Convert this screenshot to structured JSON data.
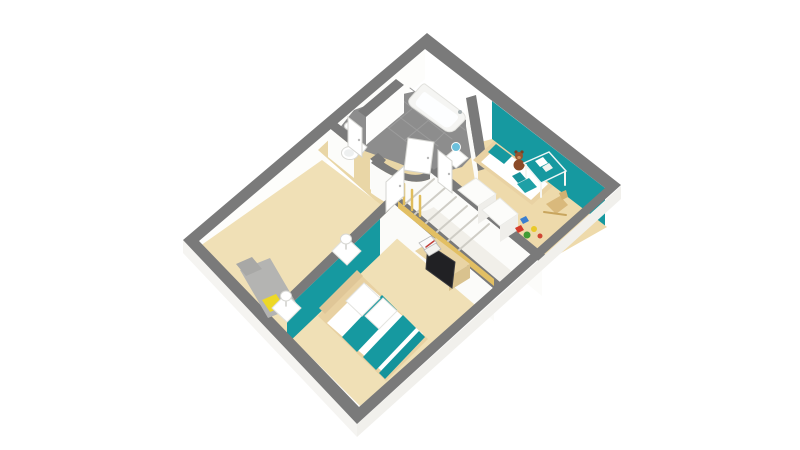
{
  "canvas": {
    "width": 800,
    "height": 450,
    "background": "#ffffff"
  },
  "palette": {
    "wall_top_gray": "#7a7a7a",
    "wall_face_white": "#fcfcfa",
    "accent_teal": "#1699a0",
    "floor_beige": "#f0e0b6",
    "floor_beige_child": "#eedaab",
    "floor_beige_hall": "#e9d6a6",
    "tile_gray": "#8d8d8d",
    "wood_light": "#e8d1a2",
    "stair_wood_yellow": "#e2bf63",
    "cushion_yellow": "#edd826",
    "bench_gray": "#b4b4b2",
    "tv_black": "#212124",
    "teddy_brown": "#8a4a28",
    "toy_red": "#d43a2a",
    "toy_green": "#3f9b35",
    "toy_yellow": "#e9c929",
    "toy_blue": "#3a7fd0"
  },
  "rooms": [
    "master-suite",
    "hall",
    "wc",
    "bathroom",
    "child-bedroom",
    "staircase"
  ],
  "shapes": [
    {
      "name": "nw-wall-inner-face",
      "type": "poly",
      "pts": "425,49 199,241 199,271 425,79",
      "fill": "#fdfdfb"
    },
    {
      "name": "ne-wall-inner-face-white",
      "type": "poly",
      "pts": "425,49 492,101 492,141 425,89",
      "fill": "#ffffff"
    },
    {
      "name": "ne-wall-inner-face-teal",
      "type": "poly",
      "pts": "492,101 605,188 605,228 492,141",
      "fill": "#1699a0"
    },
    {
      "name": "hall-floor",
      "type": "poly",
      "pts": "318,150 380,205 448,215 455,185 420,150 350,120",
      "fill": "#e9d6a6"
    },
    {
      "name": "master-suite-floor",
      "type": "poly",
      "pts": "322,160 200,246 360,406 494,292 424,228 380,204",
      "fill": "#f0e0b6"
    },
    {
      "name": "child-bedroom-floor",
      "type": "poly",
      "pts": "492,139 607,227 547,261 437,173 470,145",
      "fill": "#eedaab"
    },
    {
      "name": "staircase-strip",
      "type": "poly",
      "pts": "430,180 540,268 494,286 398,208",
      "fill": "#f1efe9"
    },
    {
      "name": "bathroom-floor-tiles",
      "type": "poly",
      "pts": "425,89 470,123 482,146 462,167 430,176 398,163 362,150 338,130 354,110 390,97",
      "fill": "#8d8d8d"
    },
    {
      "name": "tile-grout-line",
      "type": "line",
      "x1": 374,
      "y1": 117,
      "x2": 420,
      "y2": 152,
      "stroke": "#9c9c9c",
      "sw": 1
    },
    {
      "name": "tile-grout-line",
      "type": "line",
      "x1": 385,
      "y1": 106,
      "x2": 438,
      "y2": 146,
      "stroke": "#9c9c9c",
      "sw": 1
    },
    {
      "name": "tile-grout-line",
      "type": "line",
      "x1": 397,
      "y1": 96,
      "x2": 452,
      "y2": 139,
      "stroke": "#9c9c9c",
      "sw": 1
    },
    {
      "name": "tile-grout-line",
      "type": "line",
      "x1": 410,
      "y1": 88,
      "x2": 465,
      "y2": 130,
      "stroke": "#9c9c9c",
      "sw": 1
    },
    {
      "name": "tile-grout-line",
      "type": "line",
      "x1": 432,
      "y1": 92,
      "x2": 389,
      "y2": 128,
      "stroke": "#9c9c9c",
      "sw": 1
    },
    {
      "name": "tile-grout-line",
      "type": "line",
      "x1": 448,
      "y1": 104,
      "x2": 405,
      "y2": 140,
      "stroke": "#9c9c9c",
      "sw": 1
    },
    {
      "name": "tile-grout-line",
      "type": "line",
      "x1": 462,
      "y1": 115,
      "x2": 425,
      "y2": 152,
      "stroke": "#9c9c9c",
      "sw": 1
    },
    {
      "name": "wc-bath-wall-band",
      "type": "poly",
      "pts": "396,79 404,85 366,117 358,111",
      "fill": "#7a7a7a"
    },
    {
      "name": "wc-bath-wall-face",
      "type": "poly",
      "pts": "404,85 366,117 366,145 404,113",
      "fill": "#fdfdfc"
    },
    {
      "name": "bath-child-wall-face",
      "type": "poly",
      "pts": "466,98 478,171 478,199 466,126",
      "fill": "#fbfbf9"
    },
    {
      "name": "bath-child-wall-band",
      "type": "poly",
      "pts": "466,98 476,95 488,168 478,171",
      "fill": "#7a7a7a"
    },
    {
      "name": "hall-north-wall-band-a",
      "type": "poly",
      "pts": "328,127 336,122 360,141 354,148",
      "fill": "#7a7a7a"
    },
    {
      "name": "hall-north-wall-face-a",
      "type": "poly",
      "pts": "328,127 354,148 354,178 328,157",
      "fill": "#fcfcfa"
    },
    {
      "name": "hall-north-wall-band-b",
      "type": "poly",
      "pts": "370,159 378,153 386,160 380,167",
      "fill": "#7a7a7a"
    },
    {
      "name": "hall-north-wall-face-b",
      "type": "poly",
      "pts": "370,159 380,167 380,197 370,189",
      "fill": "#fcfcfa"
    },
    {
      "name": "curved-hall-wall-band",
      "type": "path",
      "d": "M376,157 Q414,186 432,168 L438,174 Q414,194 371,163 Z",
      "fill": "#7a7a7a"
    },
    {
      "name": "curved-hall-wall-face",
      "type": "path",
      "d": "M371,163 Q414,194 438,174 L438,204 Q414,224 371,193 Z",
      "fill": "#fbfbf9"
    },
    {
      "name": "master-partition-band",
      "type": "poly",
      "pts": "396,190 404,196 287,308 281,301",
      "fill": "#7a7a7a"
    },
    {
      "name": "master-partition-face-white",
      "type": "poly",
      "pts": "404,196 380,219 380,255 404,232",
      "fill": "#fbfbf9"
    },
    {
      "name": "master-partition-face-teal",
      "type": "poly",
      "pts": "380,219 287,308 287,344 380,255",
      "fill": "#1699a0"
    },
    {
      "name": "child-hall-wall-band",
      "type": "poly",
      "pts": "430,172 438,167 548,257 542,264",
      "fill": "#7a7a7a"
    },
    {
      "name": "child-hall-wall-face",
      "type": "poly",
      "pts": "430,172 542,264 542,296 430,204",
      "fill": "#fcfcfa"
    },
    {
      "name": "stair-suite-wall-band",
      "type": "poly",
      "pts": "394,204 402,199 500,282 494,289",
      "fill": "#7a7a7a"
    },
    {
      "name": "stair-suite-wall-face",
      "type": "poly",
      "pts": "394,204 494,289 494,321 394,236",
      "fill": "#fbfbf9"
    },
    {
      "name": "stair-stringer",
      "type": "poly",
      "pts": "398,208 494,286 494,279 398,201",
      "fill": "#e2bf63"
    },
    {
      "name": "stair-riser",
      "type": "line",
      "x1": 434,
      "y1": 179,
      "x2": 404,
      "y2": 205,
      "stroke": "#cfcdc6",
      "sw": 2
    },
    {
      "name": "stair-riser",
      "type": "line",
      "x1": 445,
      "y1": 188,
      "x2": 415,
      "y2": 214,
      "stroke": "#cfcdc6",
      "sw": 2
    },
    {
      "name": "stair-riser",
      "type": "line",
      "x1": 456,
      "y1": 197,
      "x2": 426,
      "y2": 223,
      "stroke": "#cfcdc6",
      "sw": 2
    },
    {
      "name": "stair-riser",
      "type": "line",
      "x1": 467,
      "y1": 206,
      "x2": 437,
      "y2": 232,
      "stroke": "#cfcdc6",
      "sw": 2
    },
    {
      "name": "stair-riser",
      "type": "line",
      "x1": 478,
      "y1": 215,
      "x2": 448,
      "y2": 241,
      "stroke": "#cfcdc6",
      "sw": 2
    },
    {
      "name": "stair-riser",
      "type": "line",
      "x1": 489,
      "y1": 224,
      "x2": 459,
      "y2": 250,
      "stroke": "#cfcdc6",
      "sw": 2
    },
    {
      "name": "stair-baluster",
      "type": "line",
      "x1": 404,
      "y1": 204,
      "x2": 404,
      "y2": 184,
      "stroke": "#e0bd5d",
      "sw": 2.5
    },
    {
      "name": "stair-baluster",
      "type": "line",
      "x1": 412,
      "y1": 210,
      "x2": 412,
      "y2": 190,
      "stroke": "#e0bd5d",
      "sw": 2.5
    },
    {
      "name": "stair-baluster",
      "type": "line",
      "x1": 420,
      "y1": 216,
      "x2": 420,
      "y2": 196,
      "stroke": "#e0bd5d",
      "sw": 2.5
    },
    {
      "name": "exterior-wall-outer-face-se",
      "type": "poly",
      "pts": "621,186 357,424 357,437 621,199",
      "fill": "#f1f0ec"
    },
    {
      "name": "exterior-wall-outer-face-sw",
      "type": "poly",
      "pts": "183,240 357,424 357,437 183,253",
      "fill": "#f5f4f1"
    },
    {
      "name": "exterior-wall-top-band",
      "type": "path",
      "d": "M427,33 L621,185 L503,291 L494,299 L357,424 L183,240 Z M425,49 L605,188 L359,407 L199,241 Z",
      "fill": "#7a7a7a",
      "rule": "evenodd"
    },
    {
      "name": "bench-seat",
      "type": "poly",
      "pts": "240,270 270,258 298,306 268,318",
      "fill": "#b4b4b2"
    },
    {
      "name": "bench-back",
      "type": "poly",
      "pts": "236,264 252,257 262,269 246,276",
      "fill": "#a8a8a6"
    },
    {
      "name": "bench-cushion-yellow",
      "type": "poly",
      "pts": "262,300 276,294 284,306 270,312",
      "fill": "#edd826"
    },
    {
      "name": "master-bed-frame",
      "type": "poly",
      "pts": "360,274 318,316 386,381 428,339",
      "fill": "#e8d1a2"
    },
    {
      "name": "master-bed-headboard",
      "type": "poly",
      "pts": "357,270 319,308 325,314 363,276",
      "fill": "#dfc697"
    },
    {
      "name": "master-bed-duvet",
      "type": "poly",
      "pts": "366,284 327,323 384,373 423,334",
      "fill": "#ffffff"
    },
    {
      "name": "duvet-teal-stripe",
      "type": "poly",
      "pts": "382,295 342,337 357,352 397,310",
      "fill": "#1699a0"
    },
    {
      "name": "duvet-teal-stripe",
      "type": "poly",
      "pts": "403,315 363,357 376,370 416,328",
      "fill": "#1699a0"
    },
    {
      "name": "duvet-teal-stripe",
      "type": "poly",
      "pts": "419,331 379,373 385,379 425,337",
      "fill": "#13939b"
    },
    {
      "name": "master-pillow",
      "type": "poly",
      "pts": "364,283 346,301 362,316 380,298",
      "fill": "#ffffff",
      "stroke": "#e4e4e0",
      "sw": 1
    },
    {
      "name": "master-pillow",
      "type": "poly",
      "pts": "383,298 365,316 379,329 397,311",
      "fill": "#ffffff",
      "stroke": "#e4e4e0",
      "sw": 1
    },
    {
      "name": "nightstand",
      "type": "poly",
      "pts": "272,308 287,322 301,308 286,294",
      "fill": "#ffffff",
      "stroke": "#e2e2de",
      "sw": 1
    },
    {
      "name": "nightstand",
      "type": "poly",
      "pts": "332,251 347,265 361,251 346,237",
      "fill": "#ffffff",
      "stroke": "#e2e2de",
      "sw": 1
    },
    {
      "name": "lamp-stem",
      "type": "line",
      "x1": 286,
      "y1": 306,
      "x2": 286,
      "y2": 299,
      "stroke": "#cfcfcb",
      "sw": 1.5
    },
    {
      "name": "bedside-lamp",
      "type": "ellipse",
      "cx": 286,
      "cy": 296,
      "rx": 5.5,
      "ry": 5,
      "fill": "#ffffff",
      "stroke": "#d8d8d4",
      "sw": 1
    },
    {
      "name": "lamp-stem",
      "type": "line",
      "x1": 346,
      "y1": 249,
      "x2": 346,
      "y2": 242,
      "stroke": "#cfcfcb",
      "sw": 1.5
    },
    {
      "name": "bedside-lamp",
      "type": "ellipse",
      "cx": 346,
      "cy": 239,
      "rx": 5.5,
      "ry": 5,
      "fill": "#ffffff",
      "stroke": "#d8d8d4",
      "sw": 1
    },
    {
      "name": "tv-cabinet-top",
      "type": "poly",
      "pts": "415,251 436,238 470,264 449,277",
      "fill": "#e9d4a4"
    },
    {
      "name": "tv-cabinet-front",
      "type": "poly",
      "pts": "449,277 470,264 470,278 449,291",
      "fill": "#d9c28e"
    },
    {
      "name": "tv-screen",
      "type": "poly",
      "pts": "428,244 455,262 452,288 426,269",
      "fill": "#212124",
      "stroke": "#3a3a3e",
      "sw": 1
    },
    {
      "name": "storage-box",
      "type": "poly",
      "pts": "419,243 431,236 437,243 425,250",
      "fill": "#fafafa",
      "stroke": "#b9b9b9",
      "sw": 0.8
    },
    {
      "name": "storage-box",
      "type": "poly",
      "pts": "424,250 436,243 441,249 429,256",
      "fill": "#f2f2ef",
      "stroke": "#b9b9b9",
      "sw": 0.8
    },
    {
      "name": "box-stripe",
      "type": "line",
      "x1": 426,
      "y1": 247,
      "x2": 434,
      "y2": 241,
      "stroke": "#c2403a",
      "sw": 1.5
    },
    {
      "name": "child-bed-frame",
      "type": "poly",
      "pts": "494,141 553,186 532,205 473,160",
      "fill": "#e9d2a3"
    },
    {
      "name": "child-bed-duvet",
      "type": "poly",
      "pts": "498,146 548,184 531,200 481,162",
      "fill": "#ffffff"
    },
    {
      "name": "child-pillow-teal",
      "type": "poly",
      "pts": "496,144 512,156 504,164 488,152",
      "fill": "#1699a0"
    },
    {
      "name": "teddy-body",
      "type": "ellipse",
      "cx": 519,
      "cy": 165,
      "rx": 5.5,
      "ry": 5.5,
      "fill": "#8a4a28"
    },
    {
      "name": "teddy-ear",
      "type": "ellipse",
      "cx": 516,
      "cy": 152,
      "rx": 1.6,
      "ry": 1.6,
      "fill": "#7a3f22"
    },
    {
      "name": "teddy-ear",
      "type": "ellipse",
      "cx": 522,
      "cy": 152,
      "rx": 1.6,
      "ry": 1.6,
      "fill": "#7a3f22"
    },
    {
      "name": "teddy-head",
      "type": "ellipse",
      "cx": 519,
      "cy": 156,
      "rx": 4,
      "ry": 4,
      "fill": "#96542e"
    },
    {
      "name": "teddy-muzzle",
      "type": "ellipse",
      "cx": 519,
      "cy": 157.5,
      "rx": 1.8,
      "ry": 1.5,
      "fill": "#c98f5e"
    },
    {
      "name": "child-nightstand",
      "type": "poly",
      "pts": "444,158 456,168 468,158 456,148",
      "fill": "#ffffff",
      "stroke": "#e2e2de",
      "sw": 1
    },
    {
      "name": "child-lamp",
      "type": "ellipse",
      "cx": 456,
      "cy": 147,
      "rx": 4.5,
      "ry": 4.5,
      "fill": "#6cc0dc",
      "stroke": "#ffffff",
      "sw": 1
    },
    {
      "name": "wardrobe-top",
      "type": "poly",
      "pts": "458,190 476,178 496,194 478,206",
      "fill": "#fcfcfa",
      "stroke": "#e8e8e4",
      "sw": 1
    },
    {
      "name": "wardrobe-front",
      "type": "poly",
      "pts": "478,206 496,194 496,212 478,224",
      "fill": "#efeeea"
    },
    {
      "name": "wardrobe-top",
      "type": "poly",
      "pts": "482,210 500,198 518,214 500,226",
      "fill": "#fcfcfa",
      "stroke": "#e8e8e4",
      "sw": 1
    },
    {
      "name": "wardrobe-front",
      "type": "poly",
      "pts": "500,226 518,214 518,230 500,242",
      "fill": "#efeeea"
    },
    {
      "name": "desk-top-teal",
      "type": "poly",
      "pts": "524,163 549,152 566,171 541,183",
      "fill": "#1699a0",
      "stroke": "#eef6f6",
      "sw": 1.5
    },
    {
      "name": "desk-leg",
      "type": "line",
      "x1": 526,
      "y1": 165,
      "x2": 526,
      "y2": 179,
      "stroke": "#f6f6f2",
      "sw": 2
    },
    {
      "name": "desk-leg",
      "type": "line",
      "x1": 541,
      "y1": 184,
      "x2": 541,
      "y2": 197,
      "stroke": "#f6f6f2",
      "sw": 2
    },
    {
      "name": "desk-leg",
      "type": "line",
      "x1": 565,
      "y1": 172,
      "x2": 565,
      "y2": 185,
      "stroke": "#f6f6f2",
      "sw": 2
    },
    {
      "name": "desk-paper",
      "type": "poly",
      "pts": "535,161 543,157 548,163 540,167",
      "fill": "#ffffff"
    },
    {
      "name": "desk-paper",
      "type": "poly",
      "pts": "542,167 549,163 553,168 546,172",
      "fill": "#f2f2ee"
    },
    {
      "name": "desk-chair-back",
      "type": "poly",
      "pts": "512,176 520,172 526,179 518,183",
      "fill": "#17929a"
    },
    {
      "name": "desk-chair-seat",
      "type": "poly",
      "pts": "517,184 529,178 537,187 525,193",
      "fill": "#1fa0a6"
    },
    {
      "name": "rocking-horse-body",
      "type": "poly",
      "pts": "546,204 560,196 568,205 556,214",
      "fill": "#d9b97c"
    },
    {
      "name": "rocking-horse-head",
      "type": "poly",
      "pts": "559,193 566,190 568,197 562,200",
      "fill": "#d2b172"
    },
    {
      "name": "rocking-horse-rocker",
      "type": "line",
      "x1": 544,
      "y1": 212,
      "x2": 566,
      "y2": 215,
      "stroke": "#c8a55e",
      "sw": 2
    },
    {
      "name": "toy-block-red",
      "type": "poly",
      "pts": "515,228 521,225 524,230 518,233",
      "fill": "#d43a2a"
    },
    {
      "name": "toy-ball-green",
      "type": "ellipse",
      "cx": 527,
      "cy": 235,
      "rx": 3.5,
      "ry": 3.5,
      "fill": "#3f9b35"
    },
    {
      "name": "toy-ball-yellow",
      "type": "ellipse",
      "cx": 534,
      "cy": 229,
      "rx": 3,
      "ry": 3,
      "fill": "#e9c929"
    },
    {
      "name": "toy-block-blue",
      "type": "poly",
      "pts": "520,219 526,216 529,221 523,224",
      "fill": "#3a7fd0"
    },
    {
      "name": "toy-ball-red",
      "type": "ellipse",
      "cx": 540,
      "cy": 236,
      "rx": 2.5,
      "ry": 2.5,
      "fill": "#cf4532"
    },
    {
      "name": "bathtub-rim",
      "type": "path",
      "d": "M425,84 L462,112 Q468,117 463,122 L455,130 Q449,134 443,129 L412,107 Q406,102 411,97 L419,88 Q423,83 425,84 Z",
      "fill": "#f5f5f3",
      "stroke": "#e1e1dd",
      "sw": 1
    },
    {
      "name": "bathtub-basin",
      "type": "path",
      "d": "M425,92 L456,114 Q460,117 456,121 L451,126 Q447,129 443,126 L418,107 Q414,104 417,100 L421,95 Q423,92 425,92 Z",
      "fill": "#fdfeff"
    },
    {
      "name": "bathtub-faucet",
      "type": "ellipse",
      "cx": 460,
      "cy": 112,
      "rx": 2,
      "ry": 2,
      "fill": "#a9b2b4"
    },
    {
      "name": "wc-basin",
      "type": "ellipse",
      "cx": 350,
      "cy": 126,
      "rx": 5.5,
      "ry": 4,
      "fill": "#ffffff",
      "stroke": "#d8d8d4",
      "sw": 1
    },
    {
      "name": "toilet-tank",
      "type": "poly",
      "pts": "357,139 367,147 361,155 351,147",
      "fill": "#ffffff",
      "stroke": "#d9d9d5",
      "sw": 1
    },
    {
      "name": "toilet-bowl",
      "type": "ellipse",
      "cx": 350,
      "cy": 153,
      "rx": 8.5,
      "ry": 6.5,
      "fill": "#ffffff",
      "stroke": "#d9d9d5",
      "sw": 1
    },
    {
      "name": "toilet-seat",
      "type": "ellipse",
      "cx": 349,
      "cy": 153,
      "rx": 5,
      "ry": 3.8,
      "fill": "#eef0f0"
    },
    {
      "name": "wc-door-leaf",
      "type": "poly",
      "pts": "348,146 362,157 362,128 348,117",
      "fill": "#ffffff",
      "stroke": "#d6d6d2",
      "sw": 1
    },
    {
      "name": "bathroom-door-leaf-open",
      "type": "poly",
      "pts": "404,170 430,174 434,142 408,138",
      "fill": "#ffffff",
      "stroke": "#d6d6d2",
      "sw": 1
    },
    {
      "name": "child-door-leaf",
      "type": "poly",
      "pts": "438,182 452,193 452,161 438,150",
      "fill": "#ffffff",
      "stroke": "#d6d6d2",
      "sw": 1
    },
    {
      "name": "master-door-leaf",
      "type": "poly",
      "pts": "386,212 404,196 404,166 386,182",
      "fill": "#ffffff",
      "stroke": "#d6d6d2",
      "sw": 1
    },
    {
      "name": "door-handle",
      "type": "ellipse",
      "cx": 359,
      "cy": 140,
      "rx": 1.2,
      "ry": 1.2,
      "fill": "#b9b9b9"
    },
    {
      "name": "door-handle",
      "type": "ellipse",
      "cx": 428,
      "cy": 158,
      "rx": 1.2,
      "ry": 1.2,
      "fill": "#b9b9b9"
    },
    {
      "name": "door-handle",
      "type": "ellipse",
      "cx": 449,
      "cy": 174,
      "rx": 1.2,
      "ry": 1.2,
      "fill": "#b9b9b9"
    },
    {
      "name": "door-handle",
      "type": "ellipse",
      "cx": 400,
      "cy": 186,
      "rx": 1.2,
      "ry": 1.2,
      "fill": "#b9b9b9"
    }
  ]
}
